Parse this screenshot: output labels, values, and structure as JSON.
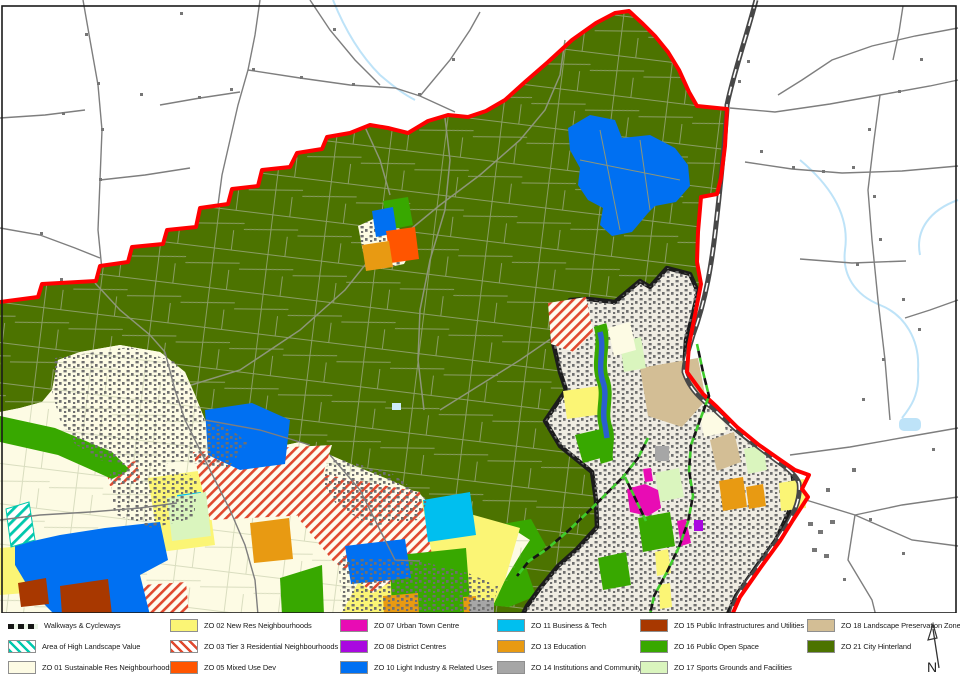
{
  "legend": {
    "items": [
      {
        "id": "walkways",
        "label": "Walkways & Cycleways",
        "symbol": "dashed-line",
        "color": "#161616"
      },
      {
        "id": "high-landscape-value",
        "label": "Area of High Landscape Value",
        "symbol": "hatch",
        "color": "#00C8AD"
      },
      {
        "id": "zo01",
        "label": "ZO 01 Sustainable Res Neighbourhoods",
        "symbol": "fill",
        "color": "#FDFBE4"
      },
      {
        "id": "zo02",
        "label": "ZO 02 New Res Neighbourhoods",
        "symbol": "fill",
        "color": "#FBF575"
      },
      {
        "id": "zo03",
        "label": "ZO 03 Tier 3 Residential Neighbourhoods",
        "symbol": "hatch",
        "color": "#E0492F"
      },
      {
        "id": "zo05",
        "label": "ZO 05 Mixed Use Dev",
        "symbol": "fill",
        "color": "#FF5500"
      },
      {
        "id": "zo07",
        "label": "ZO 07 Urban Town Centre",
        "symbol": "fill",
        "color": "#E80CB4"
      },
      {
        "id": "zo08",
        "label": "ZO 08 District Centres",
        "symbol": "fill",
        "color": "#A908E0"
      },
      {
        "id": "zo10",
        "label": "ZO 10 Light Industry & Related Uses",
        "symbol": "fill",
        "color": "#0070F2"
      },
      {
        "id": "zo11",
        "label": "ZO 11 Business & Tech",
        "symbol": "fill",
        "color": "#00BFEF"
      },
      {
        "id": "zo13",
        "label": "ZO 13 Education",
        "symbol": "fill",
        "color": "#E89A12"
      },
      {
        "id": "zo14",
        "label": "ZO 14 Institutions and Community",
        "symbol": "fill",
        "color": "#A6A6A6"
      },
      {
        "id": "zo15",
        "label": "ZO 15 Public Infrastructures and Utilities",
        "symbol": "fill",
        "color": "#A83800"
      },
      {
        "id": "zo16",
        "label": "ZO 16 Public Open Space",
        "symbol": "fill",
        "color": "#38A800"
      },
      {
        "id": "zo17",
        "label": "ZO 17 Sports Grounds and Facilities",
        "symbol": "fill",
        "color": "#DAF5BE"
      },
      {
        "id": "zo18",
        "label": "ZO 18 Landscape Preservation Zones",
        "symbol": "fill",
        "color": "#D3BE95"
      },
      {
        "id": "zo21",
        "label": "ZO 21 City Hinterland",
        "symbol": "fill",
        "color": "#4C7300"
      }
    ],
    "columns": [
      [
        0,
        1,
        2
      ],
      [
        3,
        4,
        5
      ],
      [
        6,
        7,
        8
      ],
      [
        9,
        10,
        11
      ],
      [
        12,
        13,
        14
      ],
      [
        15,
        16
      ]
    ],
    "column_x": [
      8,
      170,
      340,
      497,
      640,
      807
    ],
    "row_y": [
      6,
      27,
      48
    ]
  },
  "north_arrow": {
    "label": "N"
  },
  "map": {
    "colors": {
      "red_boundary": "#FF0000",
      "city_boundary": "#1C1C1C",
      "road": "#7E7E7E",
      "railway": "#474747",
      "stream": "#BEE3F8",
      "river": "#2B5FD0",
      "urban_base": "#EFECE2",
      "urban_speckle": "#6F6F6F",
      "field_line": "#9AA77E",
      "walkway_green": "#3FCC2C",
      "frame": "#1A1A1A"
    }
  }
}
